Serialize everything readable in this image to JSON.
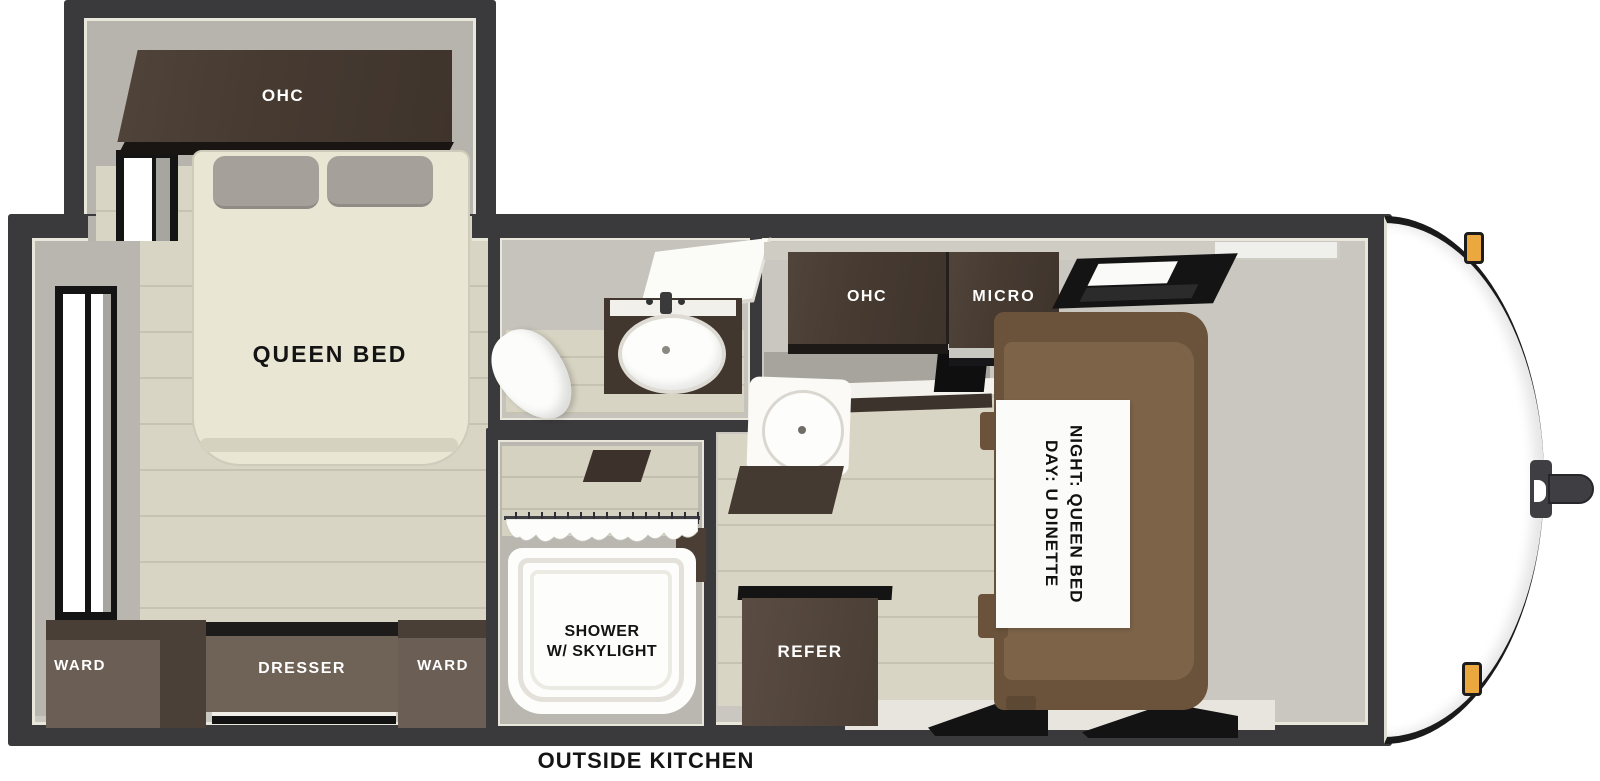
{
  "title": "Travel trailer floor plan",
  "labels": {
    "bedroom_ohc": "OHC",
    "queen_bed": "QUEEN BED",
    "ward_left": "WARD",
    "dresser": "DRESSER",
    "ward_right": "WARD",
    "kitchen_ohc": "OHC",
    "micro": "MICRO",
    "refer": "REFER",
    "shower_line1": "SHOWER",
    "shower_line2": "W/ SKYLIGHT",
    "dinette_day": "DAY: U DINETTE",
    "dinette_night": "NIGHT: QUEEN BED",
    "outside_kitchen": "OUTSIDE KITCHEN"
  },
  "colors": {
    "wall": "#3a3a3c",
    "wall_outline": "#e9e7db",
    "interior_gray": "#c9c7bf",
    "floor_beige": "#d9d5c4",
    "plank_line": "#c7c3b2",
    "cabinet_dark": "#463a31",
    "cabinet_face": "#6b5e54",
    "dinette_back": "#6b533b",
    "dinette_cushion": "#7d6348",
    "bed_cream": "#eae6d4",
    "pillow_gray": "#a5a19a",
    "refer_brown": "#4e4138",
    "marker_light_amber": "#eba83f",
    "hitch_gray": "#3e3e43",
    "label_dark": "#141414",
    "label_light": "#ffffff"
  }
}
